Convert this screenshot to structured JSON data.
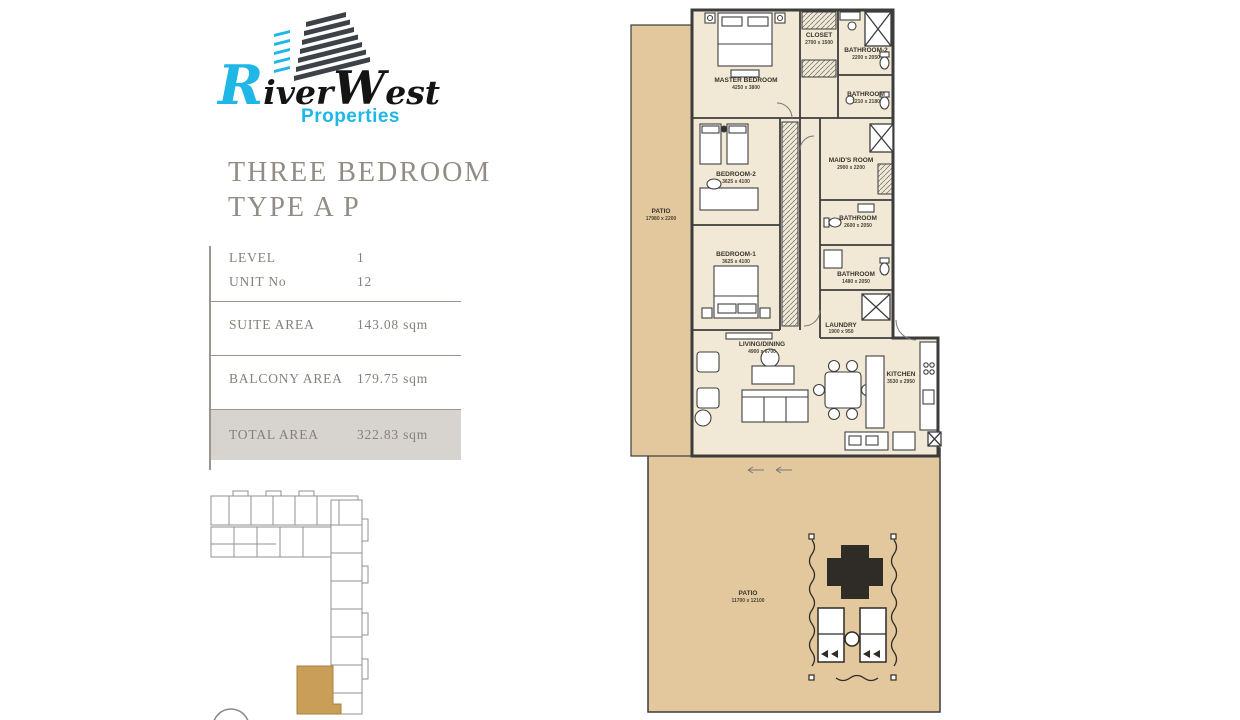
{
  "brand": {
    "name1": "River",
    "name2": "West",
    "tagline": "Properties"
  },
  "plan": {
    "title_line1": "THREE BEDROOM",
    "title_line2": "TYPE A P"
  },
  "details": {
    "rows": [
      {
        "label": "LEVEL",
        "value": "1"
      },
      {
        "label": "UNIT No",
        "value": "12"
      },
      {
        "label": "SUITE AREA",
        "value": "143.08 sqm"
      },
      {
        "label": "BALCONY AREA",
        "value": "179.75 sqm"
      },
      {
        "label": "TOTAL AREA",
        "value": "322.83 sqm"
      }
    ]
  },
  "floorplan": {
    "rooms": [
      {
        "name": "MASTER BEDROOM",
        "dims": "4250 x 3800"
      },
      {
        "name": "CLOSET",
        "dims": "2700 x 1500"
      },
      {
        "name": "BATHROOM-2",
        "dims": "2200 x 2050"
      },
      {
        "name": "BATHROOM",
        "dims": "1210 x 2180"
      },
      {
        "name": "MAID'S ROOM",
        "dims": "2900 x 2200"
      },
      {
        "name": "BEDROOM-2",
        "dims": "3625 x 4100"
      },
      {
        "name": "BATHROOM",
        "dims": "2600 x 2050"
      },
      {
        "name": "BEDROOM-1",
        "dims": "3625 x 4100"
      },
      {
        "name": "BATHROOM",
        "dims": "1480 x 2050"
      },
      {
        "name": "LAUNDRY",
        "dims": "1900 x 950"
      },
      {
        "name": "LIVING/DINING",
        "dims": "4900 x 6700"
      },
      {
        "name": "KITCHEN",
        "dims": "3530 x 2950"
      },
      {
        "name": "PATIO",
        "dims": "17980 x 2200"
      },
      {
        "name": "PATIO",
        "dims": "11700 x 12100"
      }
    ]
  },
  "colors": {
    "accent_cyan": "#1eb7e6",
    "logo_dark": "#3d4248",
    "room_fill": "#f1e9d6",
    "patio_fill": "#e3c89e",
    "wall": "#3c3c3c",
    "highlight_unit": "#c99e59",
    "total_row_bg": "#d7d3ce",
    "text_gray": "#85807a"
  }
}
